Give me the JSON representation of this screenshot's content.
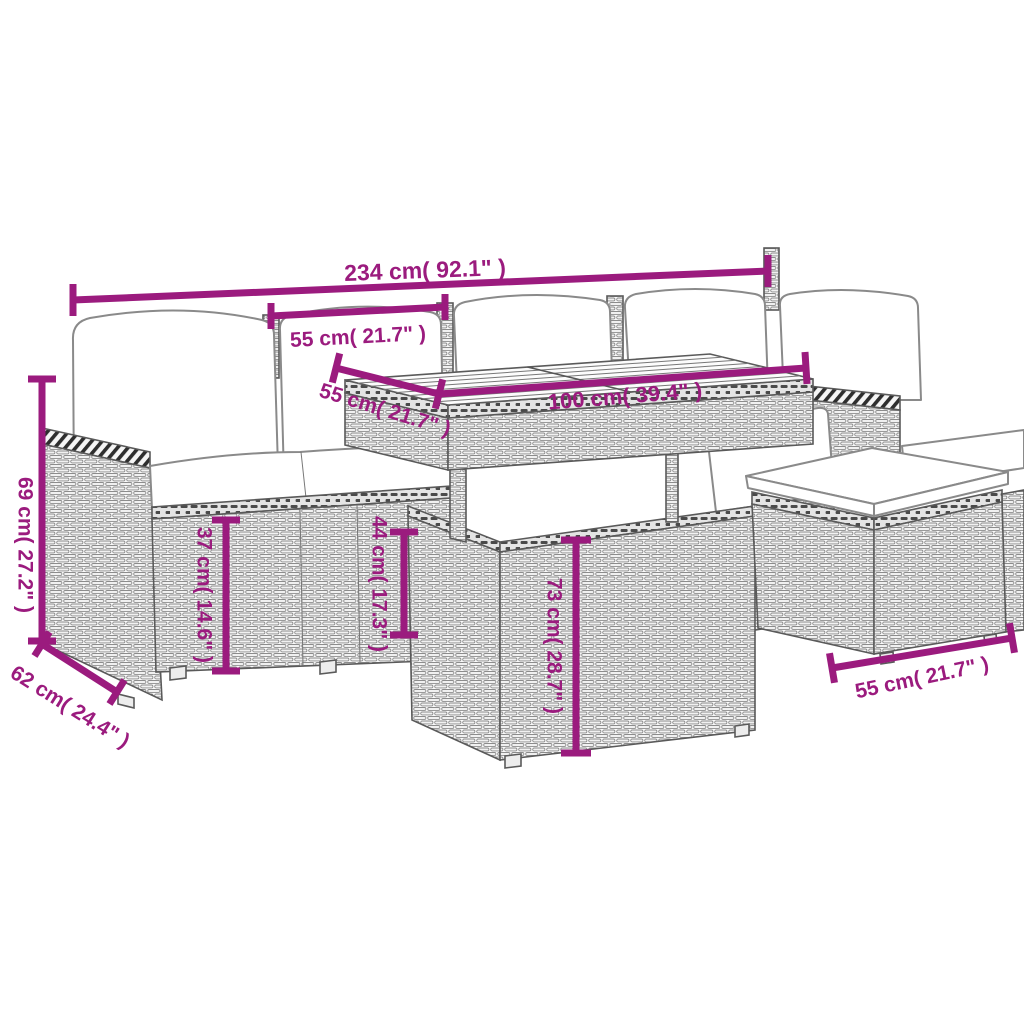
{
  "title": "Garden furniture set dimension diagram",
  "accent_color": "#9B1B7E",
  "line_art_color": "#5a5a5a",
  "dimensions": {
    "total_width": "234 cm( 92.1\" )",
    "seat_width": "55 cm( 21.7\" )",
    "back_height": "69 cm( 27.2\" )",
    "depth": "62 cm( 24.4\" )",
    "seat_height": "37 cm( 14.6\" )",
    "seat_cushion_height": "44 cm( 17.3\" )",
    "table_height": "73 cm( 28.7\" )",
    "table_length": "100 cm( 39.4\" )",
    "table_depth": "55 cm( 21.7\" )",
    "stool_width": "55 cm( 21.7\" )"
  },
  "parts": {
    "sofa": "rattan corner sofa with cushions",
    "table": "rattan table with slatted wood top",
    "stool": "rattan footstool with cushion"
  }
}
